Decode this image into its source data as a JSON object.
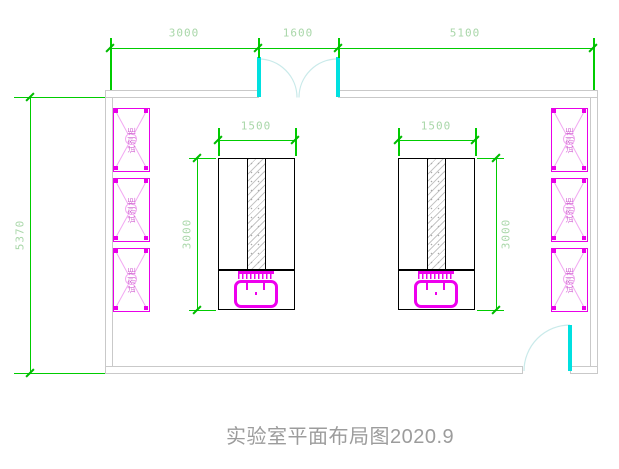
{
  "title": {
    "text": "实验室平面布局图2020.9"
  },
  "drawing_type": "laboratory floor plan (CAD)",
  "colors": {
    "dimension_line": "#00cc00",
    "dimension_text": "#a9d7a9",
    "wall": "#c9c9c9",
    "cabinet": "#ee00ee",
    "cabinet_cross": "#f2a8f2",
    "cabinet_text": "#d05fd0",
    "door_leaf": "#00e0e0",
    "door_arc": "#c9eaea",
    "bench_line": "#000000",
    "title_text": "#9c9c9c"
  },
  "dimensions": {
    "top": {
      "segments": [
        {
          "label": "3000"
        },
        {
          "label": "1600"
        },
        {
          "label": "5100"
        }
      ]
    },
    "left_wall": {
      "label": "5370"
    },
    "left_bench": {
      "width": "1500",
      "height": "3000"
    },
    "right_bench": {
      "width": "1500",
      "height": "3000"
    }
  },
  "cabinets": {
    "left": [
      {
        "label": "试剂柜"
      },
      {
        "label": "试剂柜"
      },
      {
        "label": "试剂柜"
      }
    ],
    "right": [
      {
        "label": "试剂柜"
      },
      {
        "label": "试剂柜"
      },
      {
        "label": "试剂柜"
      }
    ]
  }
}
